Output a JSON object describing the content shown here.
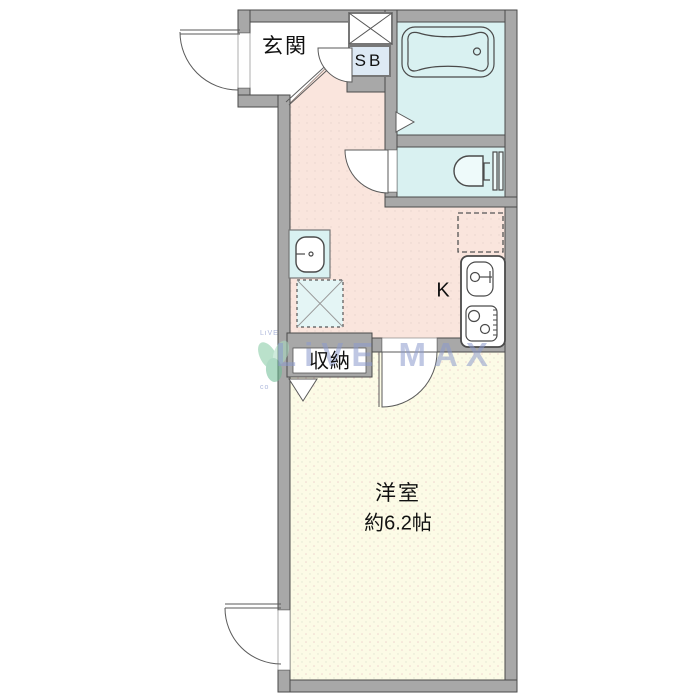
{
  "labels": {
    "entrance": "玄関",
    "shoe_box": "SB",
    "kitchen": "K",
    "closet": "収納",
    "room_name": "洋室",
    "room_size": "約6.2帖"
  },
  "watermark": {
    "text": "LiVE MAX",
    "small_top": "LiVE",
    "small_bottom": "co"
  },
  "colors": {
    "wall": "#a8a8a8",
    "outline": "#4a4a4a",
    "hall": "#fae5dd",
    "room": "#fcfbe6",
    "wet": "#d9f1f1",
    "sbfill": "#dde9f4",
    "watermark": "#8c9bcd",
    "leaf": "#82c9a2"
  }
}
